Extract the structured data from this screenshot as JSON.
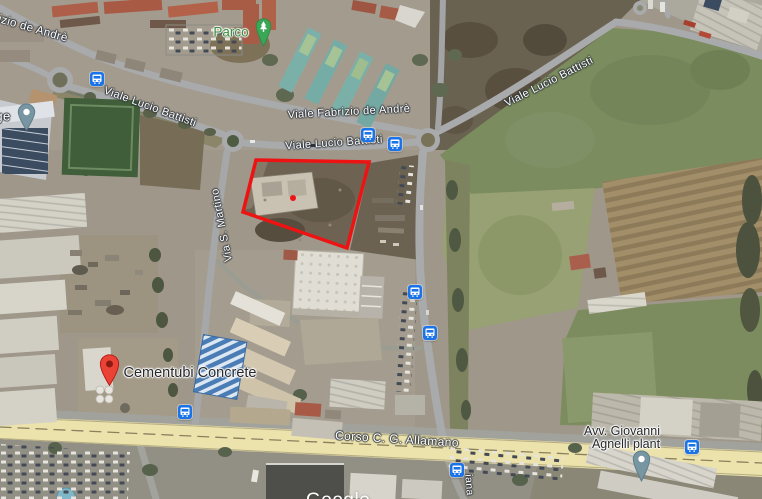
{
  "map_type": "satellite",
  "roads": {
    "battisti": "Viale Lucio Battisti",
    "fabrizio_de_andre": "Viale Fabrizio de Andrè",
    "fabrizio_de_andre_partial": "izio de Andrè",
    "san_martino": "Via S. Martino",
    "corso_allamano": "Corso C. G. Allamano",
    "street_partial_south": "iana",
    "street_partial_west": "ge"
  },
  "places": {
    "parco": "Parco",
    "cementubi": "Cementubi Concrete",
    "agnelli_line1": "Avv. Giovanni",
    "agnelli_line2": "Agnelli plant"
  },
  "watermark": "Google",
  "overlay": {
    "parcel_outline_color": "#ee1313"
  },
  "markers": {
    "bus_stop_count": 8,
    "bus_stop_color": "#1a73e8",
    "red_pin_color": "#ea4335",
    "park_pin_color": "#3aa757",
    "poi_pin_color": "#7895a2",
    "corso_road_color": "#ebe2ac"
  }
}
